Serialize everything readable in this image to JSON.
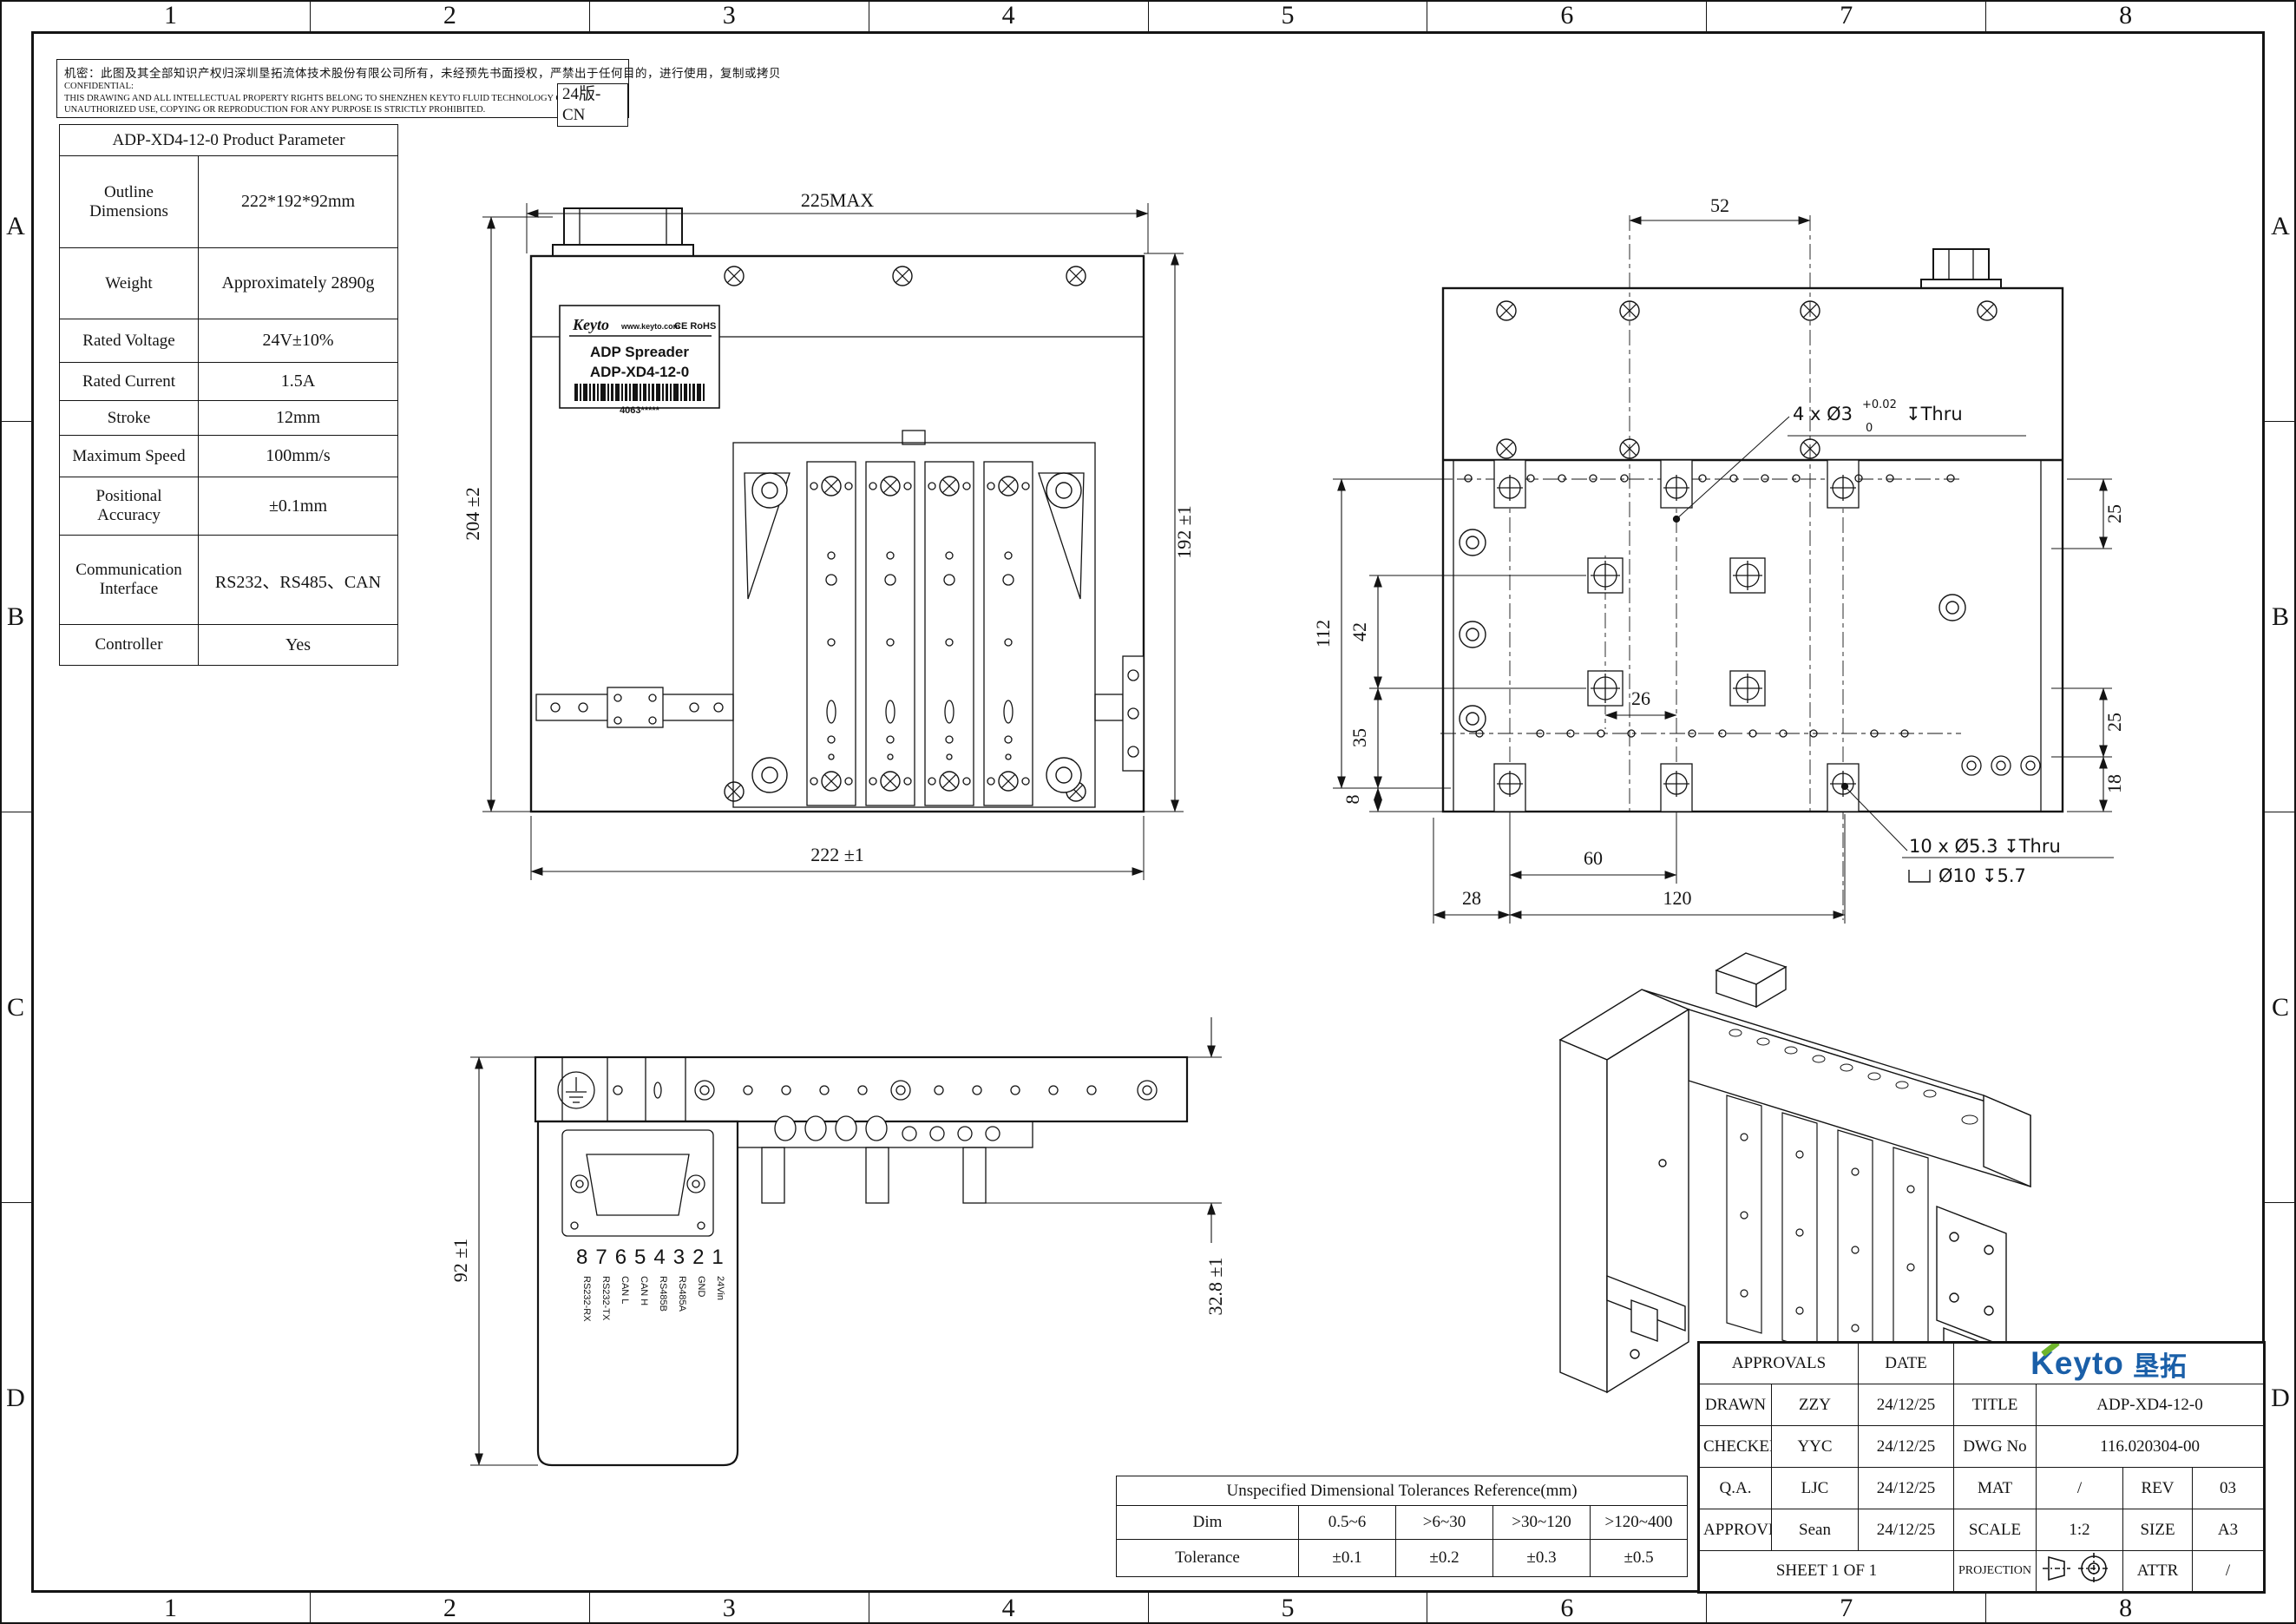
{
  "frame": {
    "cols": [
      "1",
      "2",
      "3",
      "4",
      "5",
      "6",
      "7",
      "8"
    ],
    "rows": [
      "A",
      "B",
      "C",
      "D"
    ]
  },
  "confidential": {
    "cn": "机密：此图及其全部知识产权归深圳垦拓流体技术股份有限公司所有，未经预先书面授权，严禁出于任何目的，进行使用，复制或拷贝",
    "en1": "CONFIDENTIAL:",
    "en2": "THIS DRAWING AND ALL INTELLECTUAL PROPERTY RIGHTS BELONG TO SHENZHEN KEYTO FLUID TECHNOLOGY CO., LTD.",
    "en3": "UNAUTHORIZED USE, COPYING OR REPRODUCTION FOR ANY PURPOSE IS STRICTLY PROHIBITED.",
    "badge": "24版-CN"
  },
  "param_table": {
    "title": "ADP-XD4-12-0 Product Parameter",
    "rows": [
      {
        "label": "Outline Dimensions",
        "value": "222*192*92mm"
      },
      {
        "label": "Weight",
        "value": "Approximately 2890g"
      },
      {
        "label": "Rated Voltage",
        "value": "24V±10%"
      },
      {
        "label": "Rated Current",
        "value": "1.5A"
      },
      {
        "label": "Stroke",
        "value": "12mm"
      },
      {
        "label": "Maximum Speed",
        "value": "100mm/s"
      },
      {
        "label": "Positional Accuracy",
        "value": "±0.1mm"
      },
      {
        "label": "Communication Interface",
        "value": "RS232、RS485、CAN"
      },
      {
        "label": "Controller",
        "value": "Yes"
      }
    ]
  },
  "front_view": {
    "dim_top": "225MAX",
    "dim_left": "204 ±2",
    "dim_right": "192 ±1",
    "dim_bottom": "222 ±1",
    "label": {
      "brand": "Keyto",
      "url": "www.keyto.com",
      "cert": "CE RoHS",
      "product": "ADP Spreader",
      "model": "ADP-XD4-12-0",
      "serial": "4063*****"
    }
  },
  "hole_view": {
    "dim_top": "52",
    "dim_112": "112",
    "dim_42": "42",
    "dim_35": "35",
    "dim_8": "8",
    "dim_25_top": "25",
    "dim_25_bottom": "25",
    "dim_18": "18",
    "dim_26": "26",
    "dim_60": "60",
    "dim_28": "28",
    "dim_120": "120",
    "callout_pins": {
      "prefix": "4 x Ø3",
      "tol_sup": "+0.02",
      "tol_sub": "0",
      "suffix": "↧Thru"
    },
    "callout_mount": {
      "line1": "10 x Ø5.3 ↧Thru",
      "line2": "Ø10 ↧5.7"
    }
  },
  "side_view": {
    "dim_left": "92 ±1",
    "dim_right": "32.8 ±1",
    "pin_numbers": "87654321",
    "pin_labels": [
      "RS232-RX",
      "RS232-TX",
      "CAN L",
      "CAN H",
      "RS485B",
      "RS485A",
      "GND",
      "24Vin"
    ]
  },
  "tolerance_table": {
    "title": "Unspecified Dimensional Tolerances Reference(mm)",
    "dim_label": "Dim",
    "tolerance_label": "Tolerance",
    "dims": [
      "0.5~6",
      ">6~30",
      ">30~120",
      ">120~400"
    ],
    "tolerances": [
      "±0.1",
      "±0.2",
      "±0.3",
      "±0.5"
    ]
  },
  "title_block": {
    "approvals_label": "APPROVALS",
    "date_label": "DATE",
    "logo_text": "Keyto",
    "logo_cn": "垦拓",
    "rows": [
      {
        "role": "DRAWN",
        "name": "ZZY",
        "date": "24/12/25"
      },
      {
        "role": "CHECKED",
        "name": "YYC",
        "date": "24/12/25"
      },
      {
        "role": "Q.A.",
        "name": "LJC",
        "date": "24/12/25"
      },
      {
        "role": "APPROVED",
        "name": "Sean",
        "date": "24/12/25"
      }
    ],
    "title_label": "TITLE",
    "title_value": "ADP-XD4-12-0",
    "dwg_label": "DWG No",
    "dwg_value": "116.020304-00",
    "mat_label": "MAT",
    "mat_value": "/",
    "rev_label": "REV",
    "rev_value": "03",
    "scale_label": "SCALE",
    "scale_value": "1:2",
    "size_label": "SIZE",
    "size_value": "A3",
    "sheet_label": "SHEET 1 OF 1",
    "projection_label": "PROJECTION",
    "attr_label": "ATTR",
    "attr_value": "/"
  },
  "colors": {
    "logo_blue": "#1a5fa8",
    "logo_green": "#6fb52c",
    "line": "#141414"
  }
}
